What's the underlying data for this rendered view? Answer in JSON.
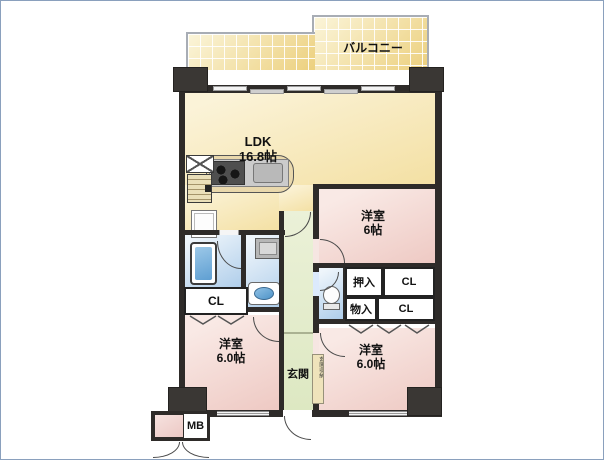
{
  "plan": {
    "balcony": {
      "label": "バルコニー"
    },
    "ldk": {
      "label": "LDK",
      "size": "16.8帖"
    },
    "bedroom_ne": {
      "label": "洋室",
      "size": "6帖"
    },
    "bedroom_sw": {
      "label": "洋室",
      "size": "6.0帖"
    },
    "bedroom_se": {
      "label": "洋室",
      "size": "6.0帖"
    },
    "genkan": {
      "label": "玄関"
    },
    "closet_w": {
      "label": "CL"
    },
    "oshiire": {
      "label": "押入"
    },
    "closet_ne": {
      "label": "CL"
    },
    "monoire": {
      "label": "物入"
    },
    "closet_e": {
      "label": "CL"
    },
    "meter_box": {
      "label": "MB"
    },
    "entrance_note": {
      "label": "玄関収納"
    }
  },
  "colors": {
    "wall": "#2e2b29",
    "balcony_fill_light": "#fbf5da",
    "balcony_fill_dark": "#ecd07e",
    "ldk_light": "#fbf3d8",
    "ldk_dark": "#f4e1a6",
    "room_pink_light": "#f9e9e5",
    "room_pink_dark": "#eec9c3",
    "hall_green_light": "#ebf1d8",
    "hall_green_dark": "#dde8c2",
    "wet_blue_light": "#eef5fb",
    "wet_blue_dark": "#aecdea",
    "counter_beige": "#e9d8ac",
    "outline_gray": "#a8adb5"
  }
}
